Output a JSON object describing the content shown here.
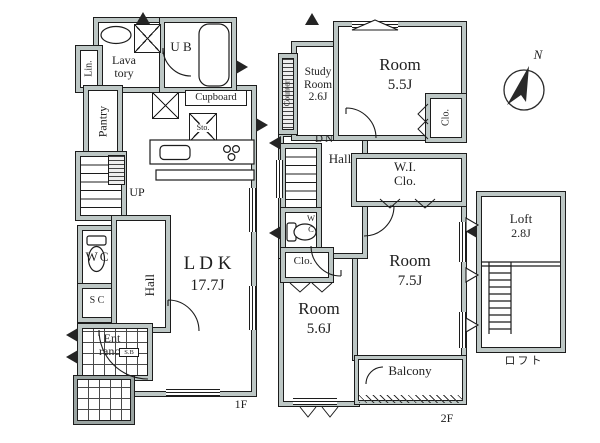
{
  "compass": {
    "north_label": "N"
  },
  "floor1": {
    "floor_label": "1F",
    "lin": "Lin.",
    "lavatory_l1": "Lava",
    "lavatory_l2": "tory",
    "ub": "U B",
    "pantry": "Pantry",
    "cupboard": "Cupboard",
    "storage": "Sto.",
    "up": "UP",
    "wc": "WC",
    "shoe_closet": "S C",
    "hall": "Hall",
    "ldk_name": "L D K",
    "ldk_size": "17.7J",
    "entrance_l1": "Ent",
    "entrance_l2": "rance",
    "shoe_box": "S.B"
  },
  "floor2": {
    "floor_label": "2F",
    "counter": "Counter",
    "study_l1": "Study",
    "study_l2": "Room",
    "study_size": "2.6J",
    "room55_name": "Room",
    "room55_size": "5.5J",
    "closet_right": "Clo.",
    "dn": "DN",
    "hall": "Hall",
    "wic_l1": "W.I.",
    "wic_l2": "Clo.",
    "wc_top": "W",
    "wc_bottom": "C",
    "closet_left": "Clo.",
    "room56_name": "Room",
    "room56_size": "5.6J",
    "room75_name": "Room",
    "room75_size": "7.5J",
    "balcony": "Balcony"
  },
  "loft": {
    "name": "Loft",
    "size": "2.8J",
    "caption": "ロフト"
  }
}
